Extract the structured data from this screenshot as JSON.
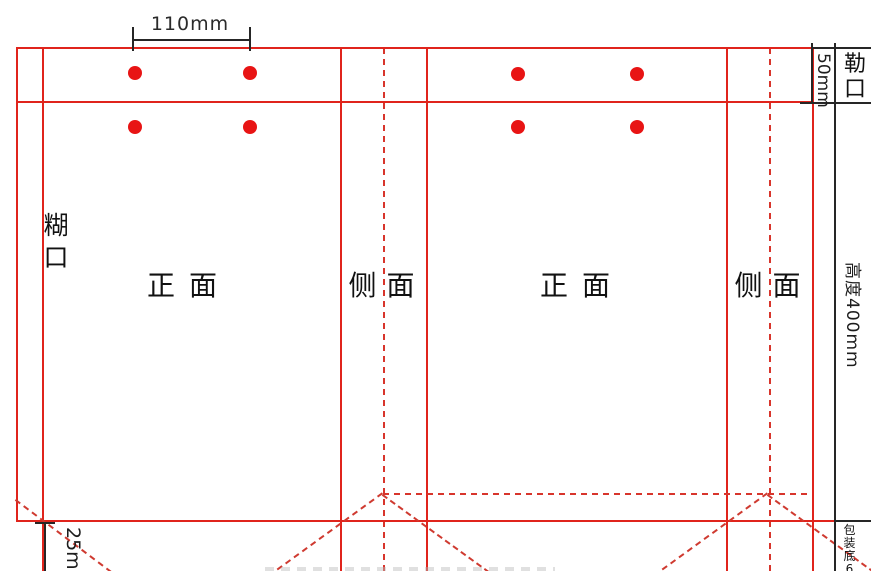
{
  "drawing": {
    "type": "paper-bag dieline (刀版图)",
    "panels": {
      "glue_flap": "糊口",
      "front_left": "正面",
      "side_left": "侧面",
      "front_right": "正面",
      "side_right": "侧面",
      "top_fold": "勒口"
    },
    "dimensions": {
      "hole_spacing": "110mm",
      "top_fold_height": "50mm",
      "bag_height": "高度400mm",
      "bottom_fold": "25mm",
      "bottom_depth": "包装底65"
    },
    "handle_holes": {
      "rows": 2,
      "holes_per_panel": 4,
      "color": "#e81414"
    }
  },
  "colors": {
    "cut_fold_red": "#e0241c",
    "dot_red": "#e81414",
    "dimension_black": "#262626",
    "background": "#ffffff"
  }
}
